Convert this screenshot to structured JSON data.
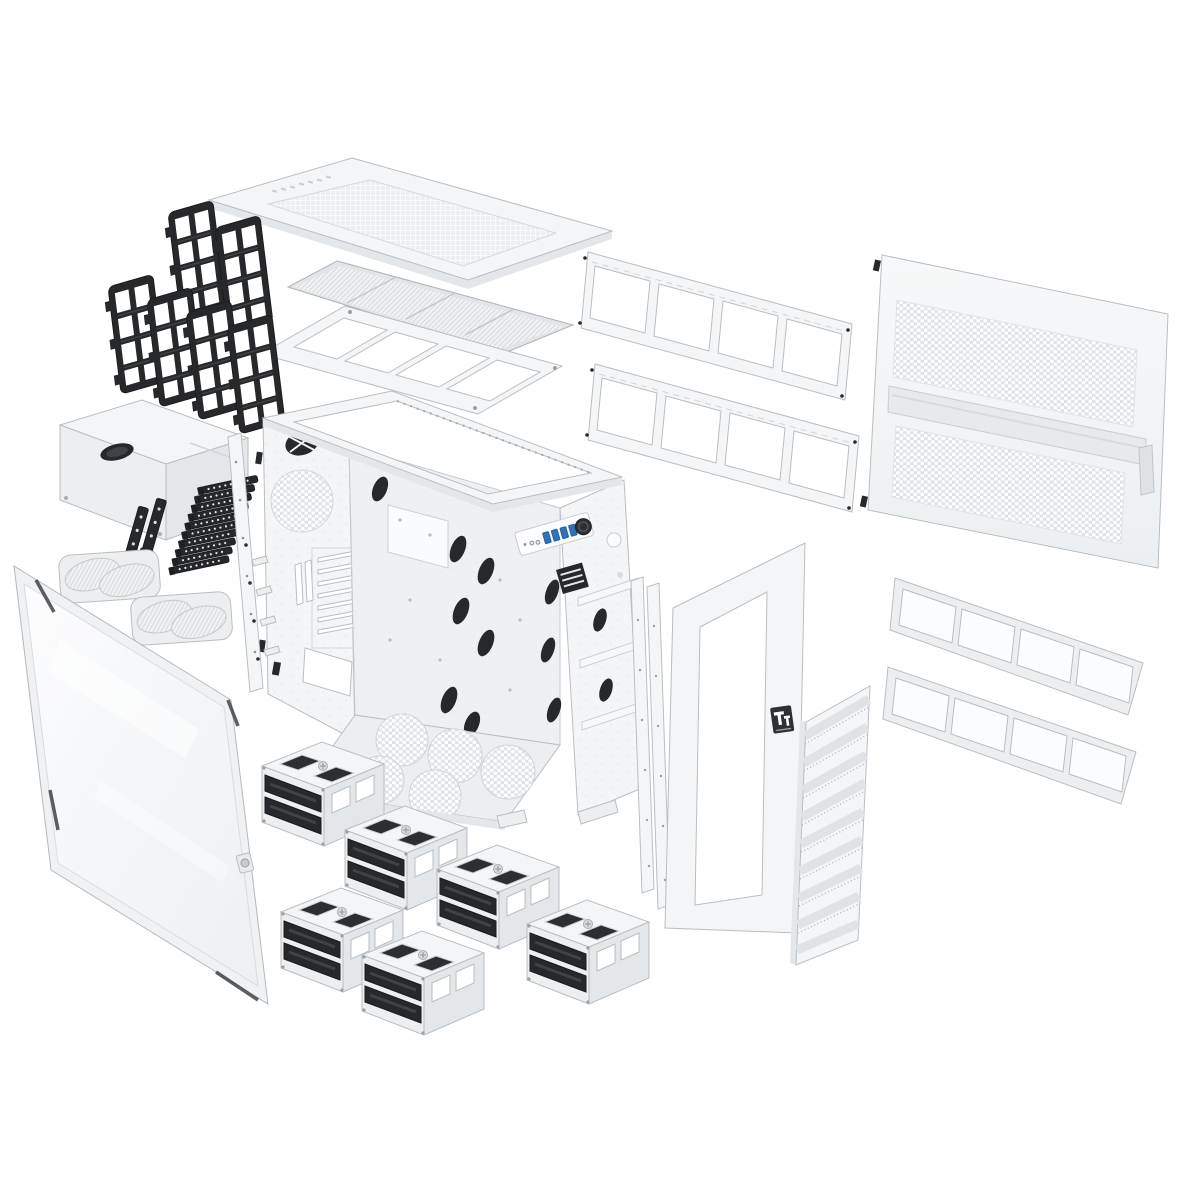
{
  "scene": {
    "title": "Exploded parts diagram — snow-white full-tower PC chassis",
    "background": "#ffffff",
    "brand": {
      "name": "Thermaltake",
      "monogram": "Tt"
    }
  },
  "palette": {
    "bg": "#ffffff",
    "panel": "#f4f5f7",
    "panel2": "#eceef0",
    "panel3": "#e4e7ea",
    "frame": "#e9ebee",
    "outline": "#b9bec4",
    "outline2": "#9aa0a6",
    "black": "#26282b",
    "blackhi": "#3f4246",
    "usb": "#3470b5",
    "badge": "#2e3032",
    "mesh": "#dfe2e5",
    "glass": "#f6f8fa"
  },
  "parts": [
    {
      "id": "top-panel",
      "label": "Top cover panel (perforated)"
    },
    {
      "id": "top-filter",
      "label": "Top magnetic dust filter"
    },
    {
      "id": "top-fan-bracket",
      "label": "Top fan / radiator mounting bracket (4 × 120 mm)"
    },
    {
      "id": "fan-frames",
      "label": "Fan mounting frames × 6 (black)"
    },
    {
      "id": "radiator-bracket-upper",
      "label": "Side radiator bracket (upper)"
    },
    {
      "id": "radiator-bracket-lower",
      "label": "Side radiator bracket (lower)"
    },
    {
      "id": "side-panel",
      "label": "Ventilated steel side panel"
    },
    {
      "id": "chassis",
      "label": "Main chassis frame"
    },
    {
      "id": "front-io",
      "label": "Front I/O — power button, audio, 4 × USB"
    },
    {
      "id": "psu-shroud",
      "label": "PSU shroud cover"
    },
    {
      "id": "slot-brackets",
      "label": "Vertical expansion brackets × 2 (black)"
    },
    {
      "id": "pci-covers",
      "label": "PCI slot covers × 10 (black)"
    },
    {
      "id": "fan-filters",
      "label": "Round fan dust filters × 2"
    },
    {
      "id": "glass-panel",
      "label": "Tempered glass side door"
    },
    {
      "id": "accessory-rail",
      "label": "Accessory mounting rail with hooks"
    },
    {
      "id": "support-rails",
      "label": "Vertical support rails × 2"
    },
    {
      "id": "front-bezel",
      "label": "Front panel frame with Tt badge"
    },
    {
      "id": "front-mesh",
      "label": "Front ventilation mesh strip"
    },
    {
      "id": "slide-filters",
      "label": "Slide-in dust filters × 2"
    },
    {
      "id": "drive-cages",
      "label": "3.5\" drive cages × 6 with removable trays"
    }
  ],
  "io": {
    "usb_ports": 4,
    "power_button": 1,
    "audio_jacks": 2
  }
}
